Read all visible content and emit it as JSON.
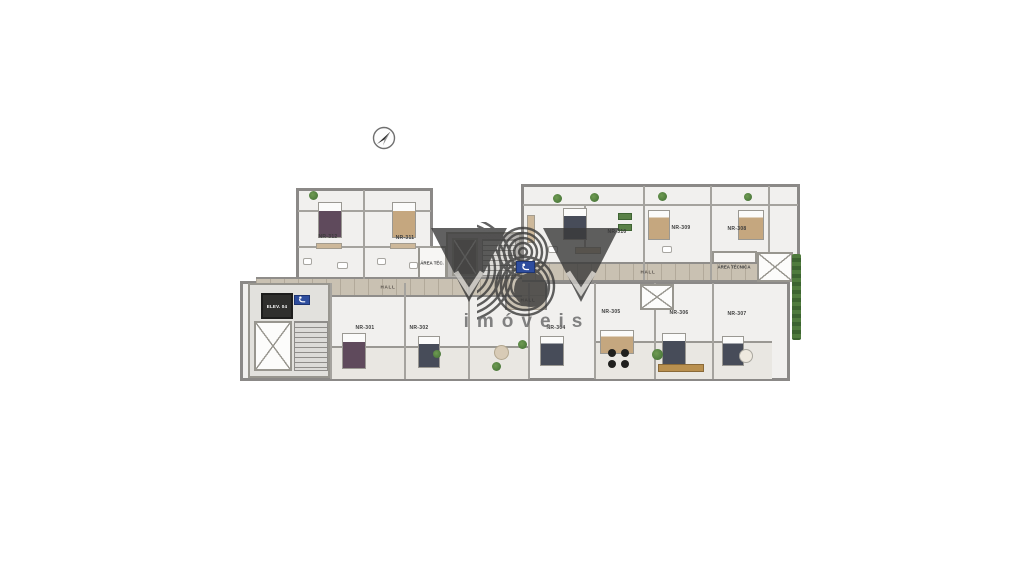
{
  "scene": {
    "kind": "architectural floor plan render",
    "background_color": "#ffffff"
  },
  "compass": {
    "icon": "north-arrow"
  },
  "watermark": {
    "monogram": "YBY",
    "text": "imóveis",
    "color": "#3a3a3a"
  },
  "plan": {
    "units": [
      {
        "label": "NR-312"
      },
      {
        "label": "NR-311"
      },
      {
        "label": "NR-310"
      },
      {
        "label": "NR-309"
      },
      {
        "label": "NR-308"
      },
      {
        "label": "NR-301"
      },
      {
        "label": "NR-302"
      },
      {
        "label": "NR-304"
      },
      {
        "label": "NR-305"
      },
      {
        "label": "NR-306"
      },
      {
        "label": "NR-307"
      }
    ],
    "halls": [
      {
        "label": "HALL"
      },
      {
        "label": "HALL"
      },
      {
        "label": "HALL"
      }
    ],
    "service": {
      "area_tec": "ÁREA TÉC.",
      "area_tecnica": "ÁREA TÉCNICA",
      "elevator": "ELEV. 04"
    },
    "icons": {
      "accessibility_sign_core": "accessibility",
      "accessibility_sign_center": "accessibility"
    },
    "colors": {
      "wall": "#8b8987",
      "room_floor": "#f1f0ee",
      "corridor_floor": "#c9c1b2",
      "core_floor": "#e2e1dd",
      "balcony_floor": "#e9e7e2",
      "accessibility_sign": "#2e4d9e",
      "vegetation": "#4d7a3c"
    }
  }
}
